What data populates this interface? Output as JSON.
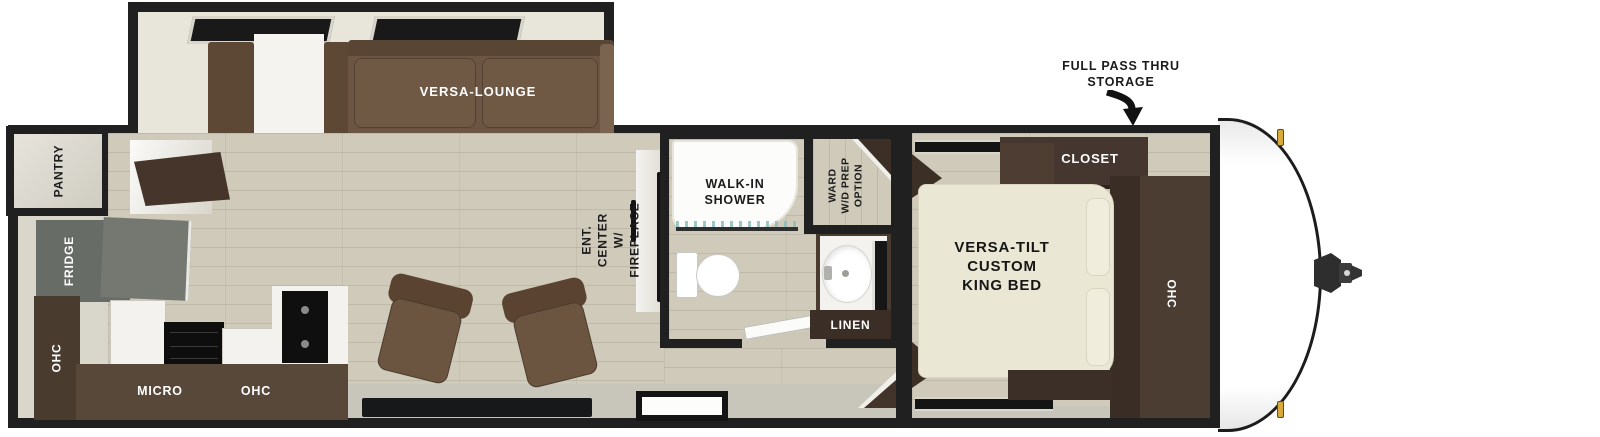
{
  "title": "Travel trailer floor plan",
  "colors": {
    "wall": "#1f201f",
    "interior_wall": "#d9d6cb",
    "wood_floor": "#cfcaba",
    "walkway_gray": "#c8c6bb",
    "sofa_brown": "#6c5643",
    "cabinet_dark_brown": "#47392e",
    "counter_brown": "#57483a",
    "fridge_gray": "#686c67",
    "bed_cream": "#ebe7d5",
    "appliance_black": "#0f0f0f",
    "marker_light_amber": "#d9a93c",
    "label_dark": "#1b1b1b",
    "label_light": "#ffffff"
  },
  "exterior": {
    "storage_callout": "FULL PASS THRU\nSTORAGE"
  },
  "living_area": {
    "lounge": "VERSA-LOUNGE",
    "ent_center": "ENT. CENTER\nW/ FIREPLACE"
  },
  "kitchen": {
    "pantry": "PANTRY",
    "fridge": "FRIDGE",
    "ohc_left": "OHC",
    "micro": "MICRO",
    "ohc_bottom": "OHC"
  },
  "bathroom": {
    "shower": "WALK-IN\nSHOWER",
    "ward": "WARD\nW/D PREP\nOPTION",
    "linen": "LINEN"
  },
  "bedroom": {
    "closet": "CLOSET",
    "bed": "VERSA-TILT\nCUSTOM\nKING BED",
    "ohc": "OHC"
  }
}
